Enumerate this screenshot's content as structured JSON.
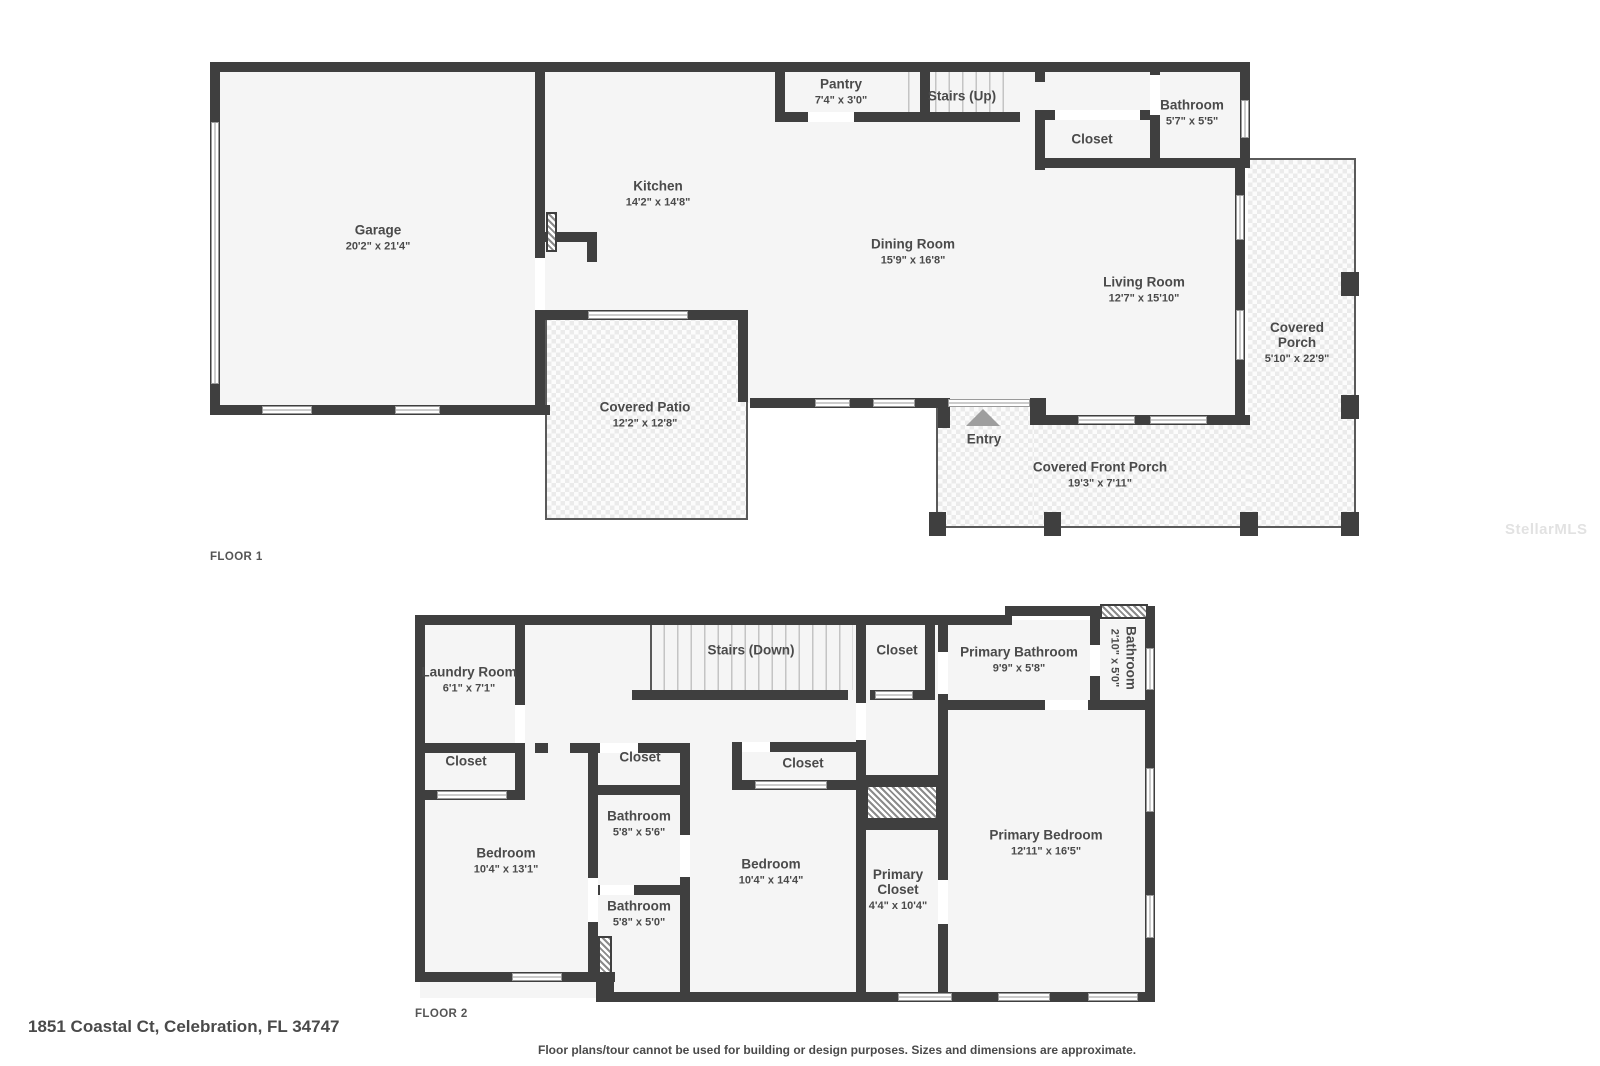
{
  "meta": {
    "address": "1851 Coastal Ct, Celebration, FL 34747",
    "disclaimer": "Floor plans/tour cannot be used for building or design purposes. Sizes and dimensions are approximate.",
    "watermark": "StellarMLS",
    "wall_color": "#3f3f3f",
    "room_fill_color": "#f5f5f5",
    "label_color": "#4a4a4a"
  },
  "floor1": {
    "label": "FLOOR 1",
    "rooms": {
      "garage": {
        "name": "Garage",
        "dims": "20'2\" x 21'4\""
      },
      "kitchen": {
        "name": "Kitchen",
        "dims": "14'2\" x 14'8\""
      },
      "pantry": {
        "name": "Pantry",
        "dims": "7'4\" x 3'0\""
      },
      "stairs_up": {
        "name": "Stairs (Up)",
        "dims": ""
      },
      "closet": {
        "name": "Closet",
        "dims": ""
      },
      "bathroom": {
        "name": "Bathroom",
        "dims": "5'7\" x 5'5\""
      },
      "dining": {
        "name": "Dining Room",
        "dims": "15'9\" x 16'8\""
      },
      "living": {
        "name": "Living Room",
        "dims": "12'7\" x 15'10\""
      },
      "covered_porch": {
        "name": "Covered Porch",
        "dims": "5'10\" x 22'9\""
      },
      "covered_patio": {
        "name": "Covered Patio",
        "dims": "12'2\" x 12'8\""
      },
      "front_porch": {
        "name": "Covered Front Porch",
        "dims": "19'3\" x 7'11\""
      },
      "entry": {
        "name": "Entry",
        "dims": ""
      }
    }
  },
  "floor2": {
    "label": "FLOOR 2",
    "rooms": {
      "laundry": {
        "name": "Laundry Room",
        "dims": "6'1\" x 7'1\""
      },
      "stairs_down": {
        "name": "Stairs (Down)",
        "dims": ""
      },
      "closet_top": {
        "name": "Closet",
        "dims": ""
      },
      "primary_bathroom": {
        "name": "Primary Bathroom",
        "dims": "9'9\" x 5'8\""
      },
      "bathroom_small": {
        "name": "Bathroom",
        "dims": "2'10\" x 5'0\""
      },
      "closet_left": {
        "name": "Closet",
        "dims": ""
      },
      "closet_mid": {
        "name": "Closet",
        "dims": ""
      },
      "closet_third": {
        "name": "Closet",
        "dims": ""
      },
      "bathroom1": {
        "name": "Bathroom",
        "dims": "5'8\" x 5'6\""
      },
      "bathroom2": {
        "name": "Bathroom",
        "dims": "5'8\" x 5'0\""
      },
      "bedroom_left": {
        "name": "Bedroom",
        "dims": "10'4\" x 13'1\""
      },
      "bedroom_mid": {
        "name": "Bedroom",
        "dims": "10'4\" x 14'4\""
      },
      "primary_closet": {
        "name": "Primary Closet",
        "dims": "4'4\" x 10'4\""
      },
      "primary_bedroom": {
        "name": "Primary Bedroom",
        "dims": "12'11\" x 16'5\""
      }
    }
  }
}
